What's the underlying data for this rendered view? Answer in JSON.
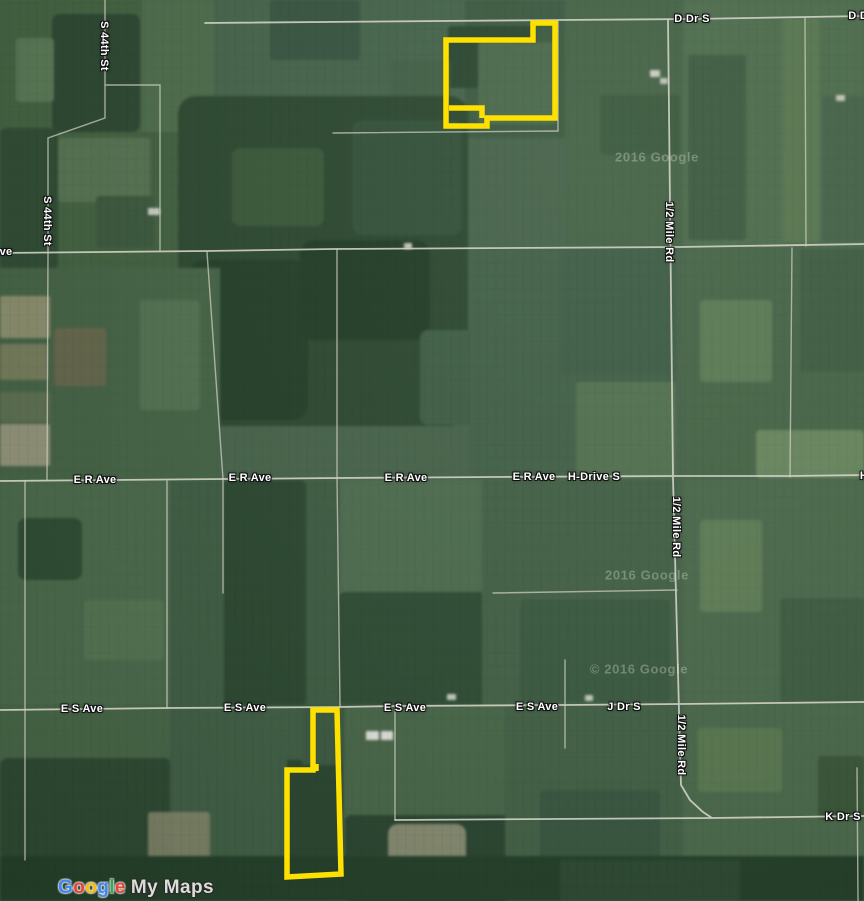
{
  "map": {
    "polygon_color": "#ffe100",
    "road_labels": [
      {
        "text": "D Dr S"
      },
      {
        "text": "D Dr S"
      },
      {
        "text": "S 44th St"
      },
      {
        "text": "S 44th St"
      },
      {
        "text": "ve"
      },
      {
        "text": "E R Ave"
      },
      {
        "text": "E R Ave"
      },
      {
        "text": "E R Ave"
      },
      {
        "text": "E R Ave"
      },
      {
        "text": "H-Drive S"
      },
      {
        "text": "H-Drive S"
      },
      {
        "text": "1/2 Mile Rd"
      },
      {
        "text": "1/2 Mile Rd"
      },
      {
        "text": "1/2 Mile Rd"
      },
      {
        "text": "E S Ave"
      },
      {
        "text": "E S Ave"
      },
      {
        "text": "E S Ave"
      },
      {
        "text": "E S Ave"
      },
      {
        "text": "J Dr S"
      },
      {
        "text": "K Dr S"
      }
    ],
    "watermarks": [
      {
        "text": "2016 Google"
      },
      {
        "text": "2016 Google"
      },
      {
        "text": "© 2016 Google"
      }
    ],
    "logo": {
      "letters": [
        {
          "char": "G",
          "color": "#4285F4"
        },
        {
          "char": "o",
          "color": "#EA4335"
        },
        {
          "char": "o",
          "color": "#FBBC05"
        },
        {
          "char": "g",
          "color": "#4285F4"
        },
        {
          "char": "l",
          "color": "#34A853"
        },
        {
          "char": "e",
          "color": "#EA4335"
        }
      ],
      "suffix": "My Maps"
    }
  }
}
